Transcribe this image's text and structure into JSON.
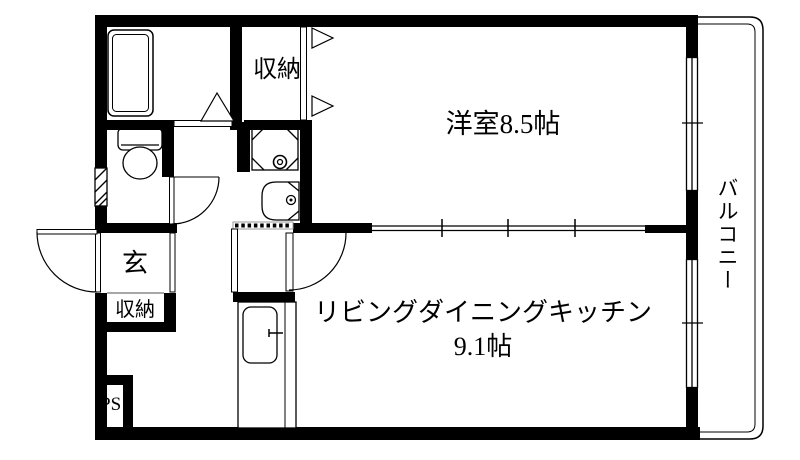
{
  "colors": {
    "wall": "#000000",
    "background": "#ffffff",
    "thin_gray_line": "#8a8a8a"
  },
  "rooms": {
    "western": {
      "label": "洋室8.5帖"
    },
    "ldk": {
      "label": "リビングダイニングキッチン",
      "size": "9.1帖"
    },
    "balcony": {
      "label": "バルコニー"
    },
    "upper_closet": {
      "label": "収納"
    },
    "entrance": {
      "label": "玄"
    },
    "entrance_closet": {
      "label": "収納"
    },
    "pipe_space": {
      "label": "PS"
    }
  }
}
